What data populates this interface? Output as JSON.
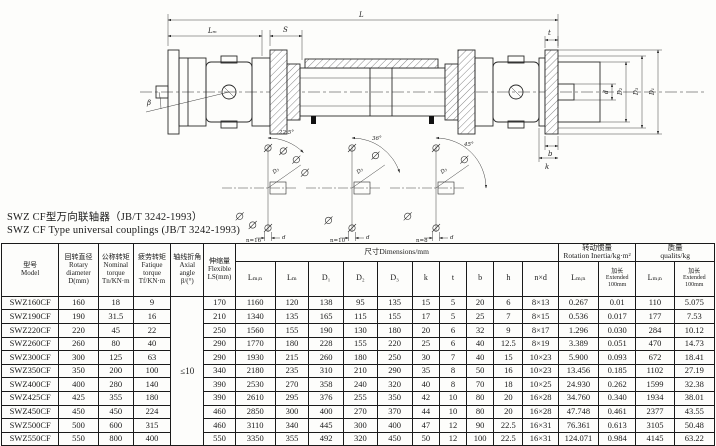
{
  "title": {
    "line1": "SWZ CF型万向联轴器（JB/T 3242-1993）",
    "line2": "SWZ CF Type universal couplings (JB/T 3242-1993)"
  },
  "drawing": {
    "labels": {
      "L": "L",
      "Lm": "Lₘ",
      "S": "S",
      "beta": "β",
      "t": "t",
      "b": "b",
      "k": "k",
      "d": "d",
      "D1": "D₁",
      "D2": "D₂",
      "D3": "D₃",
      "a1": "22.5°",
      "a2": "36°",
      "a3": "45°",
      "n16": "n=16",
      "n10": "n=10",
      "n8": "n=8"
    }
  },
  "table": {
    "headers": {
      "model": "型号\nModel",
      "d": "回转直径\nRotary\ndiameter\nD(mm)",
      "tn": "公称转矩\nNominal\ntorque\nTn/KN·m",
      "tf": "疲劳转矩\nFatique\ntorque\nTf/KN·m",
      "angle": "轴线折角\nAxial angle\nβ/(°)",
      "ls": "伸缩量\nFlexible\nLS(mm)",
      "dims_group": "尺寸Dimensions/mm",
      "inertia_group": "转动惯量\nRotation Inertia/kg·m²",
      "mass_group": "质量\nqualits/kg",
      "lmin": "Lₘᵢₙ",
      "lm": "Lₘ",
      "d1": "D₁",
      "d2": "D₂",
      "d3": "D₃",
      "k": "k",
      "t": "t",
      "b": "b",
      "h": "h",
      "nxd": "n×d",
      "ext": "加长\nExtended\n100mm"
    },
    "axial_angle_value": "≤10",
    "rows": [
      [
        "SWZ160CF",
        "160",
        "18",
        "9",
        "170",
        "1160",
        "120",
        "138",
        "95",
        "135",
        "15",
        "5",
        "20",
        "6",
        "8×13",
        "0.267",
        "0.01",
        "110",
        "5.075"
      ],
      [
        "SWZ190CF",
        "190",
        "31.5",
        "16",
        "210",
        "1340",
        "135",
        "165",
        "115",
        "155",
        "17",
        "5",
        "25",
        "7",
        "8×15",
        "0.536",
        "0.017",
        "177",
        "7.53"
      ],
      [
        "SWZ220CF",
        "220",
        "45",
        "22",
        "250",
        "1560",
        "155",
        "190",
        "130",
        "180",
        "20",
        "6",
        "32",
        "9",
        "8×17",
        "1.296",
        "0.030",
        "284",
        "10.12"
      ],
      [
        "SWZ260CF",
        "260",
        "80",
        "40",
        "290",
        "1770",
        "180",
        "228",
        "155",
        "220",
        "25",
        "6",
        "40",
        "12.5",
        "8×19",
        "3.389",
        "0.051",
        "470",
        "14.73"
      ],
      [
        "SWZ300CF",
        "300",
        "125",
        "63",
        "290",
        "1930",
        "215",
        "260",
        "180",
        "250",
        "30",
        "7",
        "40",
        "15",
        "10×23",
        "5.900",
        "0.093",
        "672",
        "18.41"
      ],
      [
        "SWZ350CF",
        "350",
        "200",
        "100",
        "340",
        "2180",
        "235",
        "310",
        "210",
        "290",
        "35",
        "8",
        "50",
        "16",
        "10×23",
        "13.456",
        "0.185",
        "1102",
        "27.19"
      ],
      [
        "SWZ400CF",
        "400",
        "280",
        "140",
        "390",
        "2530",
        "270",
        "358",
        "240",
        "320",
        "40",
        "8",
        "70",
        "18",
        "10×25",
        "24.930",
        "0.262",
        "1599",
        "32.38"
      ],
      [
        "SWZ425CF",
        "425",
        "355",
        "180",
        "390",
        "2610",
        "295",
        "376",
        "255",
        "350",
        "42",
        "10",
        "80",
        "20",
        "16×28",
        "34.760",
        "0.340",
        "1934",
        "38.01"
      ],
      [
        "SWZ450CF",
        "450",
        "450",
        "224",
        "460",
        "2850",
        "300",
        "400",
        "270",
        "370",
        "44",
        "10",
        "80",
        "20",
        "16×28",
        "47.748",
        "0.461",
        "2377",
        "43.55"
      ],
      [
        "SWZ500CF",
        "500",
        "600",
        "315",
        "460",
        "3110",
        "340",
        "445",
        "300",
        "400",
        "47",
        "12",
        "90",
        "22.5",
        "16×31",
        "76.361",
        "0.613",
        "3105",
        "50.48"
      ],
      [
        "SWZ550CF",
        "550",
        "800",
        "400",
        "550",
        "3350",
        "355",
        "492",
        "320",
        "450",
        "50",
        "12",
        "100",
        "22.5",
        "16×31",
        "124.071",
        "0.984",
        "4145",
        "63.22"
      ]
    ]
  }
}
